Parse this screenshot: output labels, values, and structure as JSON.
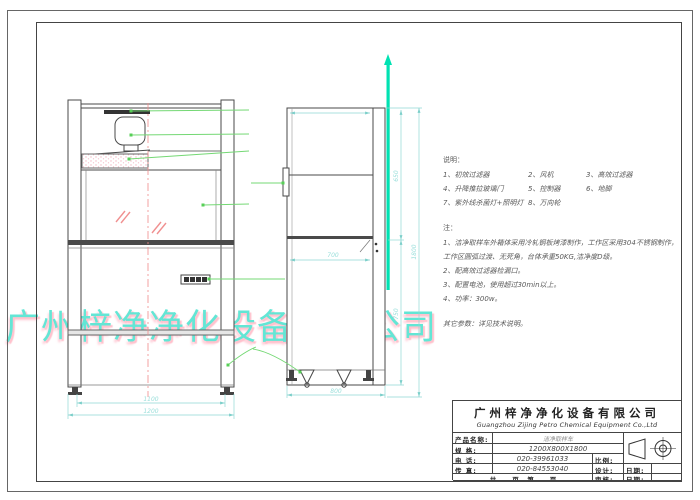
{
  "watermark": {
    "text": "广州梓净净化设备有限公司",
    "color": "#63e6d5",
    "shadow_color": "#ffc2cd"
  },
  "notes": {
    "legend_title": "说明：",
    "legend_rows": [
      {
        "c1": "1、初效过滤器",
        "c2": "2、风机",
        "c3": "3、高效过滤器"
      },
      {
        "c1": "4、升降推拉玻璃门",
        "c2": "5、控制器",
        "c3": "6、地脚"
      },
      {
        "c1": "7、紫外线杀菌灯+照明灯",
        "c2": "8、万向轮",
        "c3": ""
      }
    ],
    "remarks_title": "注：",
    "remarks": [
      "1、洁净取样车外箱体采用冷轧钢板烤漆制作，工作区采用304不锈钢制作，",
      "工作区圆弧过渡、无死角，台体承重50KG,洁净度D级。",
      "2、配高效过滤器检漏口。",
      "3、配置电池，使用超过30min以上。",
      "4、功率：300w。"
    ],
    "other_params": "其它参数：详见技术说明。"
  },
  "dimensions": {
    "front_feet_span": "1100",
    "front_width": "1200",
    "side_depth_bottom": "800",
    "side_work_depth": "700",
    "side_upper_height": "650",
    "side_lower_height": "750",
    "side_total_height": "1800"
  },
  "colors": {
    "dimension": "#8fd8d4",
    "leader": "#74d874",
    "centerline": "#f08a8a",
    "highlight_marker": "#00e2b2",
    "glass_hatch": "#f09090"
  },
  "title_block": {
    "company_cn": "广州梓净净化设备有限公司",
    "company_en": "Guangzhou Zijing Petro Chemical Equipment Co.,Ltd",
    "product_label": "产品名称:",
    "product_value": "洁净取样车",
    "spec_label": "规  格:",
    "spec_value": "1200X800X1800",
    "tel_label": "电  话:",
    "tel_value": "020-39961033",
    "scale_label": "比例:",
    "fax_label": "传  真:",
    "fax_value": "020-84553040",
    "design_label": "设计:",
    "date_label_1": "日期:",
    "pages_label": "共　　页　第　　页",
    "audit_label": "审核:",
    "date_label_2": "日期:"
  }
}
